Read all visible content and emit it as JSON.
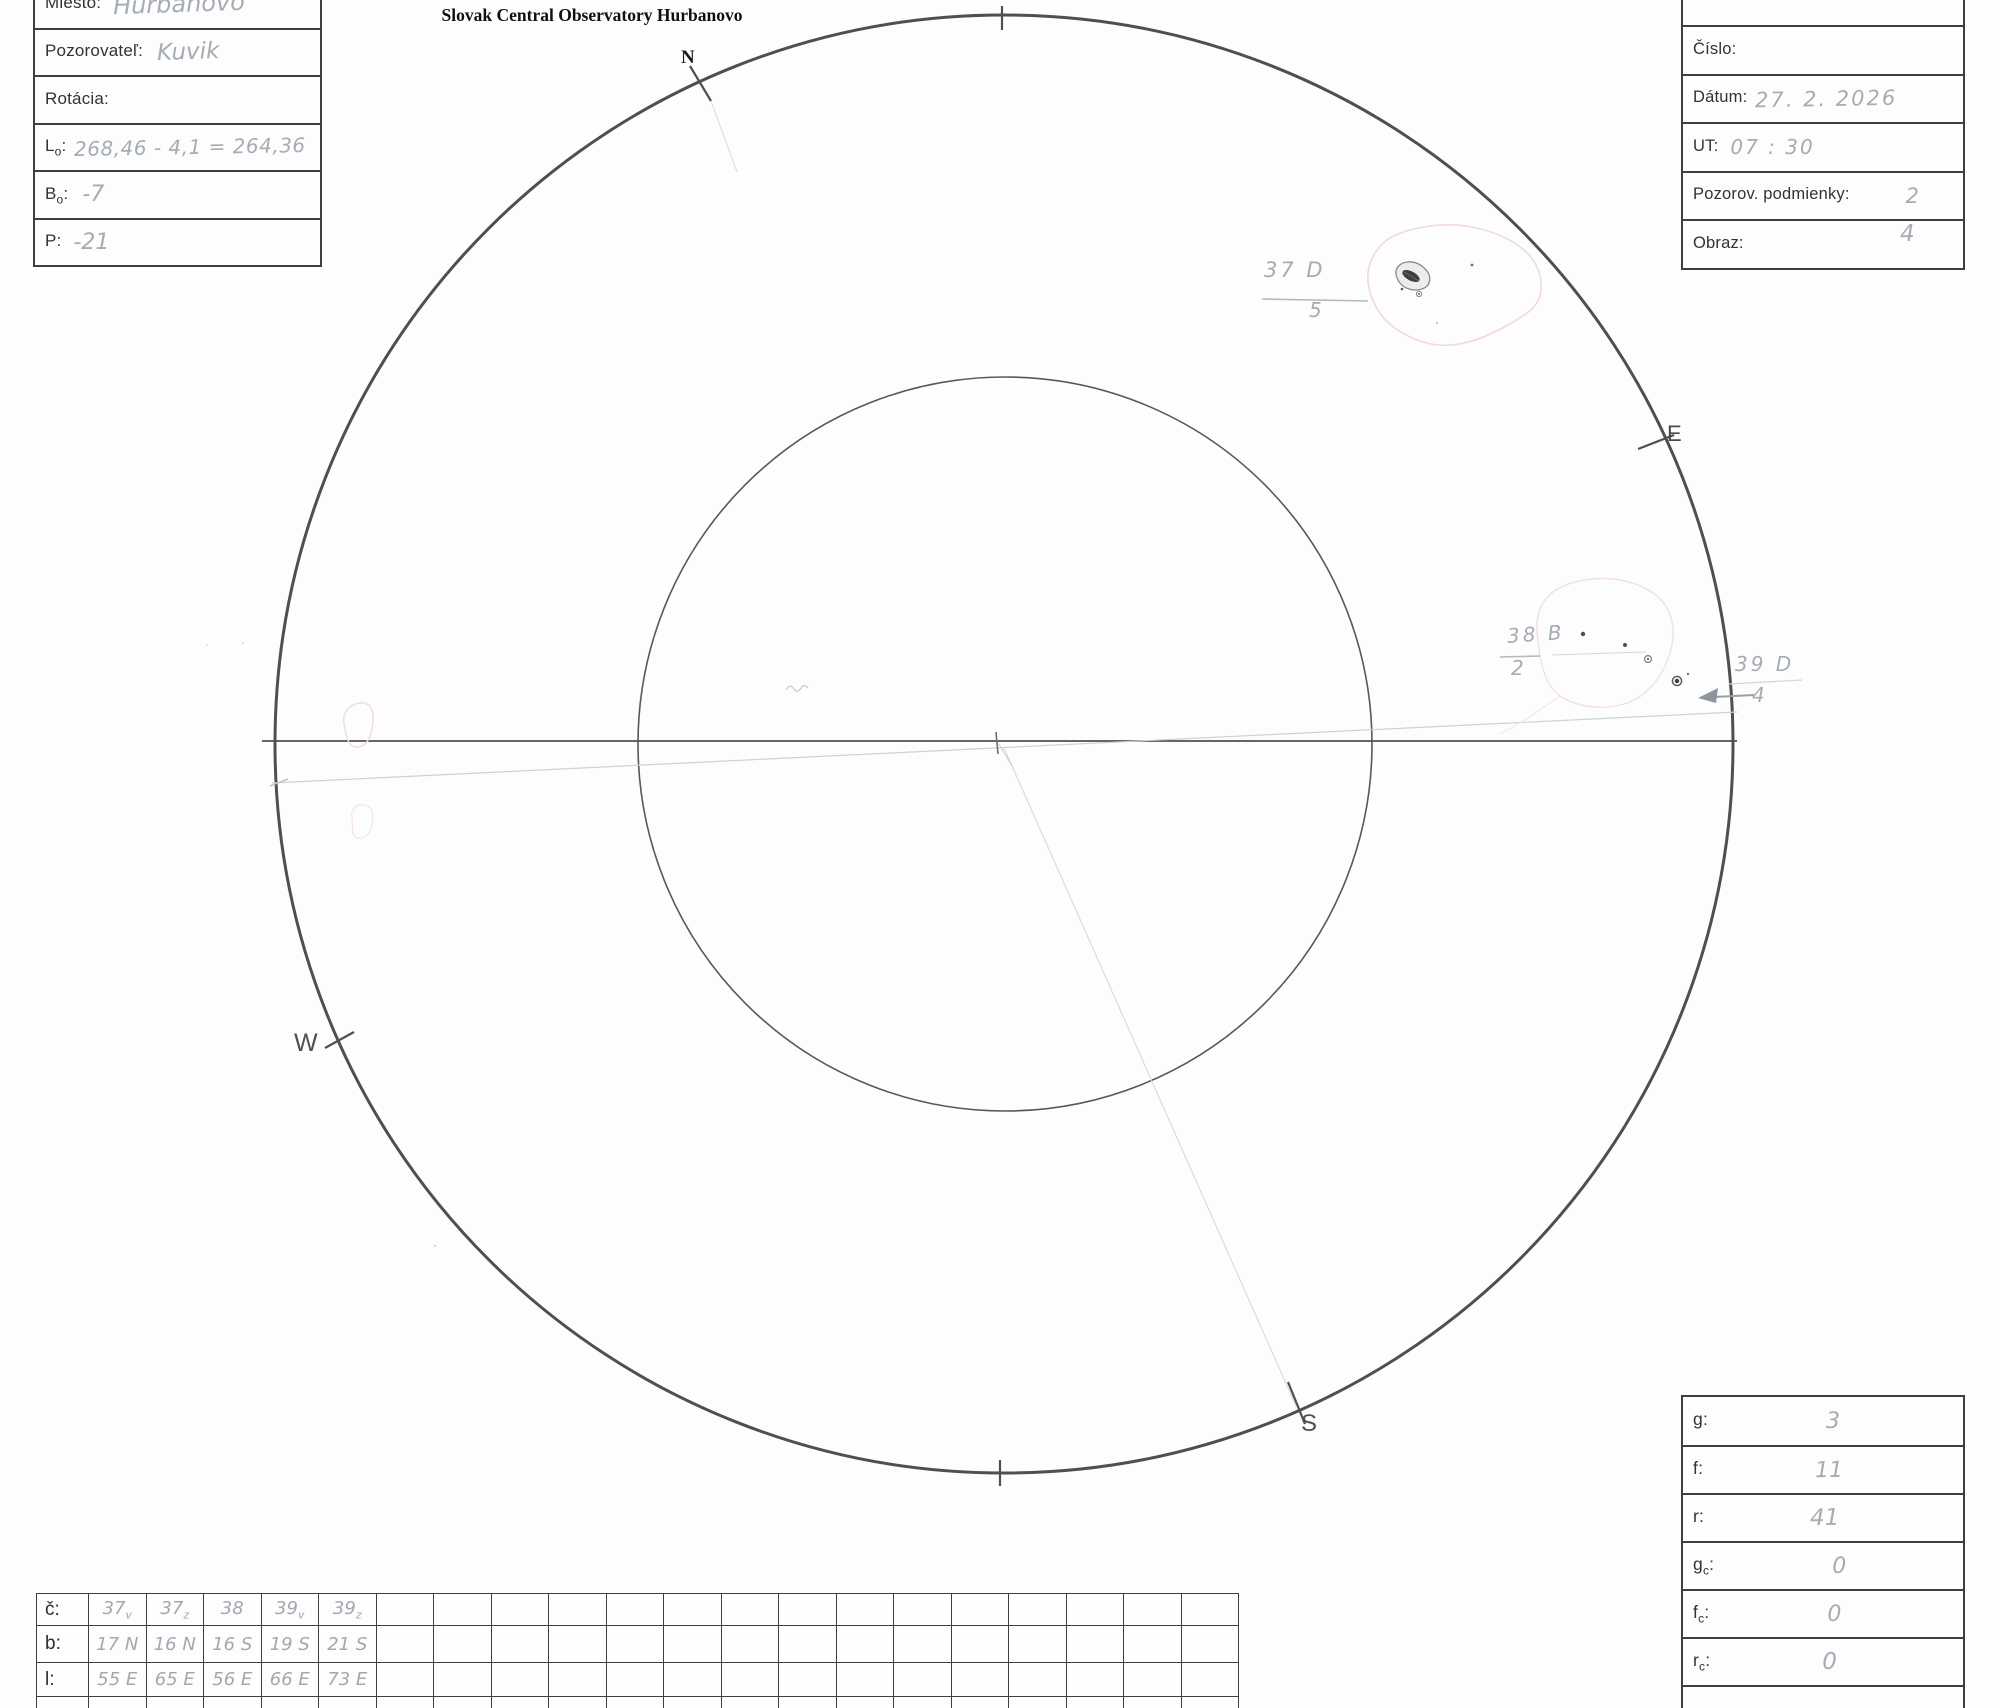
{
  "title": "Slovak Central Observatory Hurbanovo",
  "compass": {
    "n": "N",
    "e": "E",
    "s": "S",
    "w": "W"
  },
  "observer_box": {
    "rows": [
      {
        "label_main": "Miesto:",
        "label_sub": "",
        "label_end": "",
        "value": "Hurbanovo"
      },
      {
        "label_main": "Pozorovateľ:",
        "label_sub": "",
        "label_end": "",
        "value": "Kuvik"
      },
      {
        "label_main": "Rotácia:",
        "label_sub": "",
        "label_end": "",
        "value": ""
      },
      {
        "label_main": "L",
        "label_sub": "o",
        "label_end": ":",
        "value": "268,46 - 4,1 = 264,36"
      },
      {
        "label_main": "B",
        "label_sub": "o",
        "label_end": ":",
        "value": "-7"
      },
      {
        "label_main": "P",
        "label_sub": "",
        "label_end": ":",
        "value": "-21"
      }
    ]
  },
  "session_box": {
    "rows": [
      {
        "label_main": "Číslo:",
        "label_sub": "",
        "label_end": "",
        "value": ""
      },
      {
        "label_main": "Dátum:",
        "label_sub": "",
        "label_end": "",
        "value": "27. 2. 2026"
      },
      {
        "label_main": "UT:",
        "label_sub": "",
        "label_end": "",
        "value": "07 : 30"
      },
      {
        "label_main": "Pozorov. podmienky:",
        "label_sub": "",
        "label_end": "",
        "value": "2"
      },
      {
        "label_main": "Obraz:",
        "label_sub": "",
        "label_end": "",
        "value": "4"
      }
    ]
  },
  "counts_box": {
    "rows": [
      {
        "label_main": "g",
        "label_sub": "",
        "label_end": ":",
        "value": "3"
      },
      {
        "label_main": "f",
        "label_sub": "",
        "label_end": ":",
        "value": "11"
      },
      {
        "label_main": "r",
        "label_sub": "",
        "label_end": ":",
        "value": "41"
      },
      {
        "label_main": "g",
        "label_sub": "c",
        "label_end": ":",
        "value": "0"
      },
      {
        "label_main": "f",
        "label_sub": "c",
        "label_end": ":",
        "value": "0"
      },
      {
        "label_main": "r",
        "label_sub": "c",
        "label_end": ":",
        "value": "0"
      }
    ]
  },
  "spot_table": {
    "row_c_label": "č:",
    "row_b_label": "b:",
    "row_l_label": "l:",
    "row_c": [
      {
        "n": "37",
        "s": "v"
      },
      {
        "n": "37",
        "s": "z"
      },
      {
        "n": "38",
        "s": ""
      },
      {
        "n": "39",
        "s": "v"
      },
      {
        "n": "39",
        "s": "z"
      }
    ],
    "row_b": [
      "17 N",
      "16 N",
      "16 S",
      "19 S",
      "21 S"
    ],
    "row_l": [
      "55 E",
      "65 E",
      "56 E",
      "66 E",
      "73 E"
    ]
  },
  "annotations": {
    "g37": {
      "top": "37 D",
      "bottom": "5"
    },
    "g38": {
      "top": "38 B",
      "bottom": "2"
    },
    "g39": {
      "top": "39 D",
      "bottom": "4"
    }
  },
  "colors": {
    "pencil": "#a6acb4",
    "ink": "#323232",
    "circle": "#4f4f4f",
    "faculae": "#f2dcdc",
    "umbra": "#3c4043"
  }
}
